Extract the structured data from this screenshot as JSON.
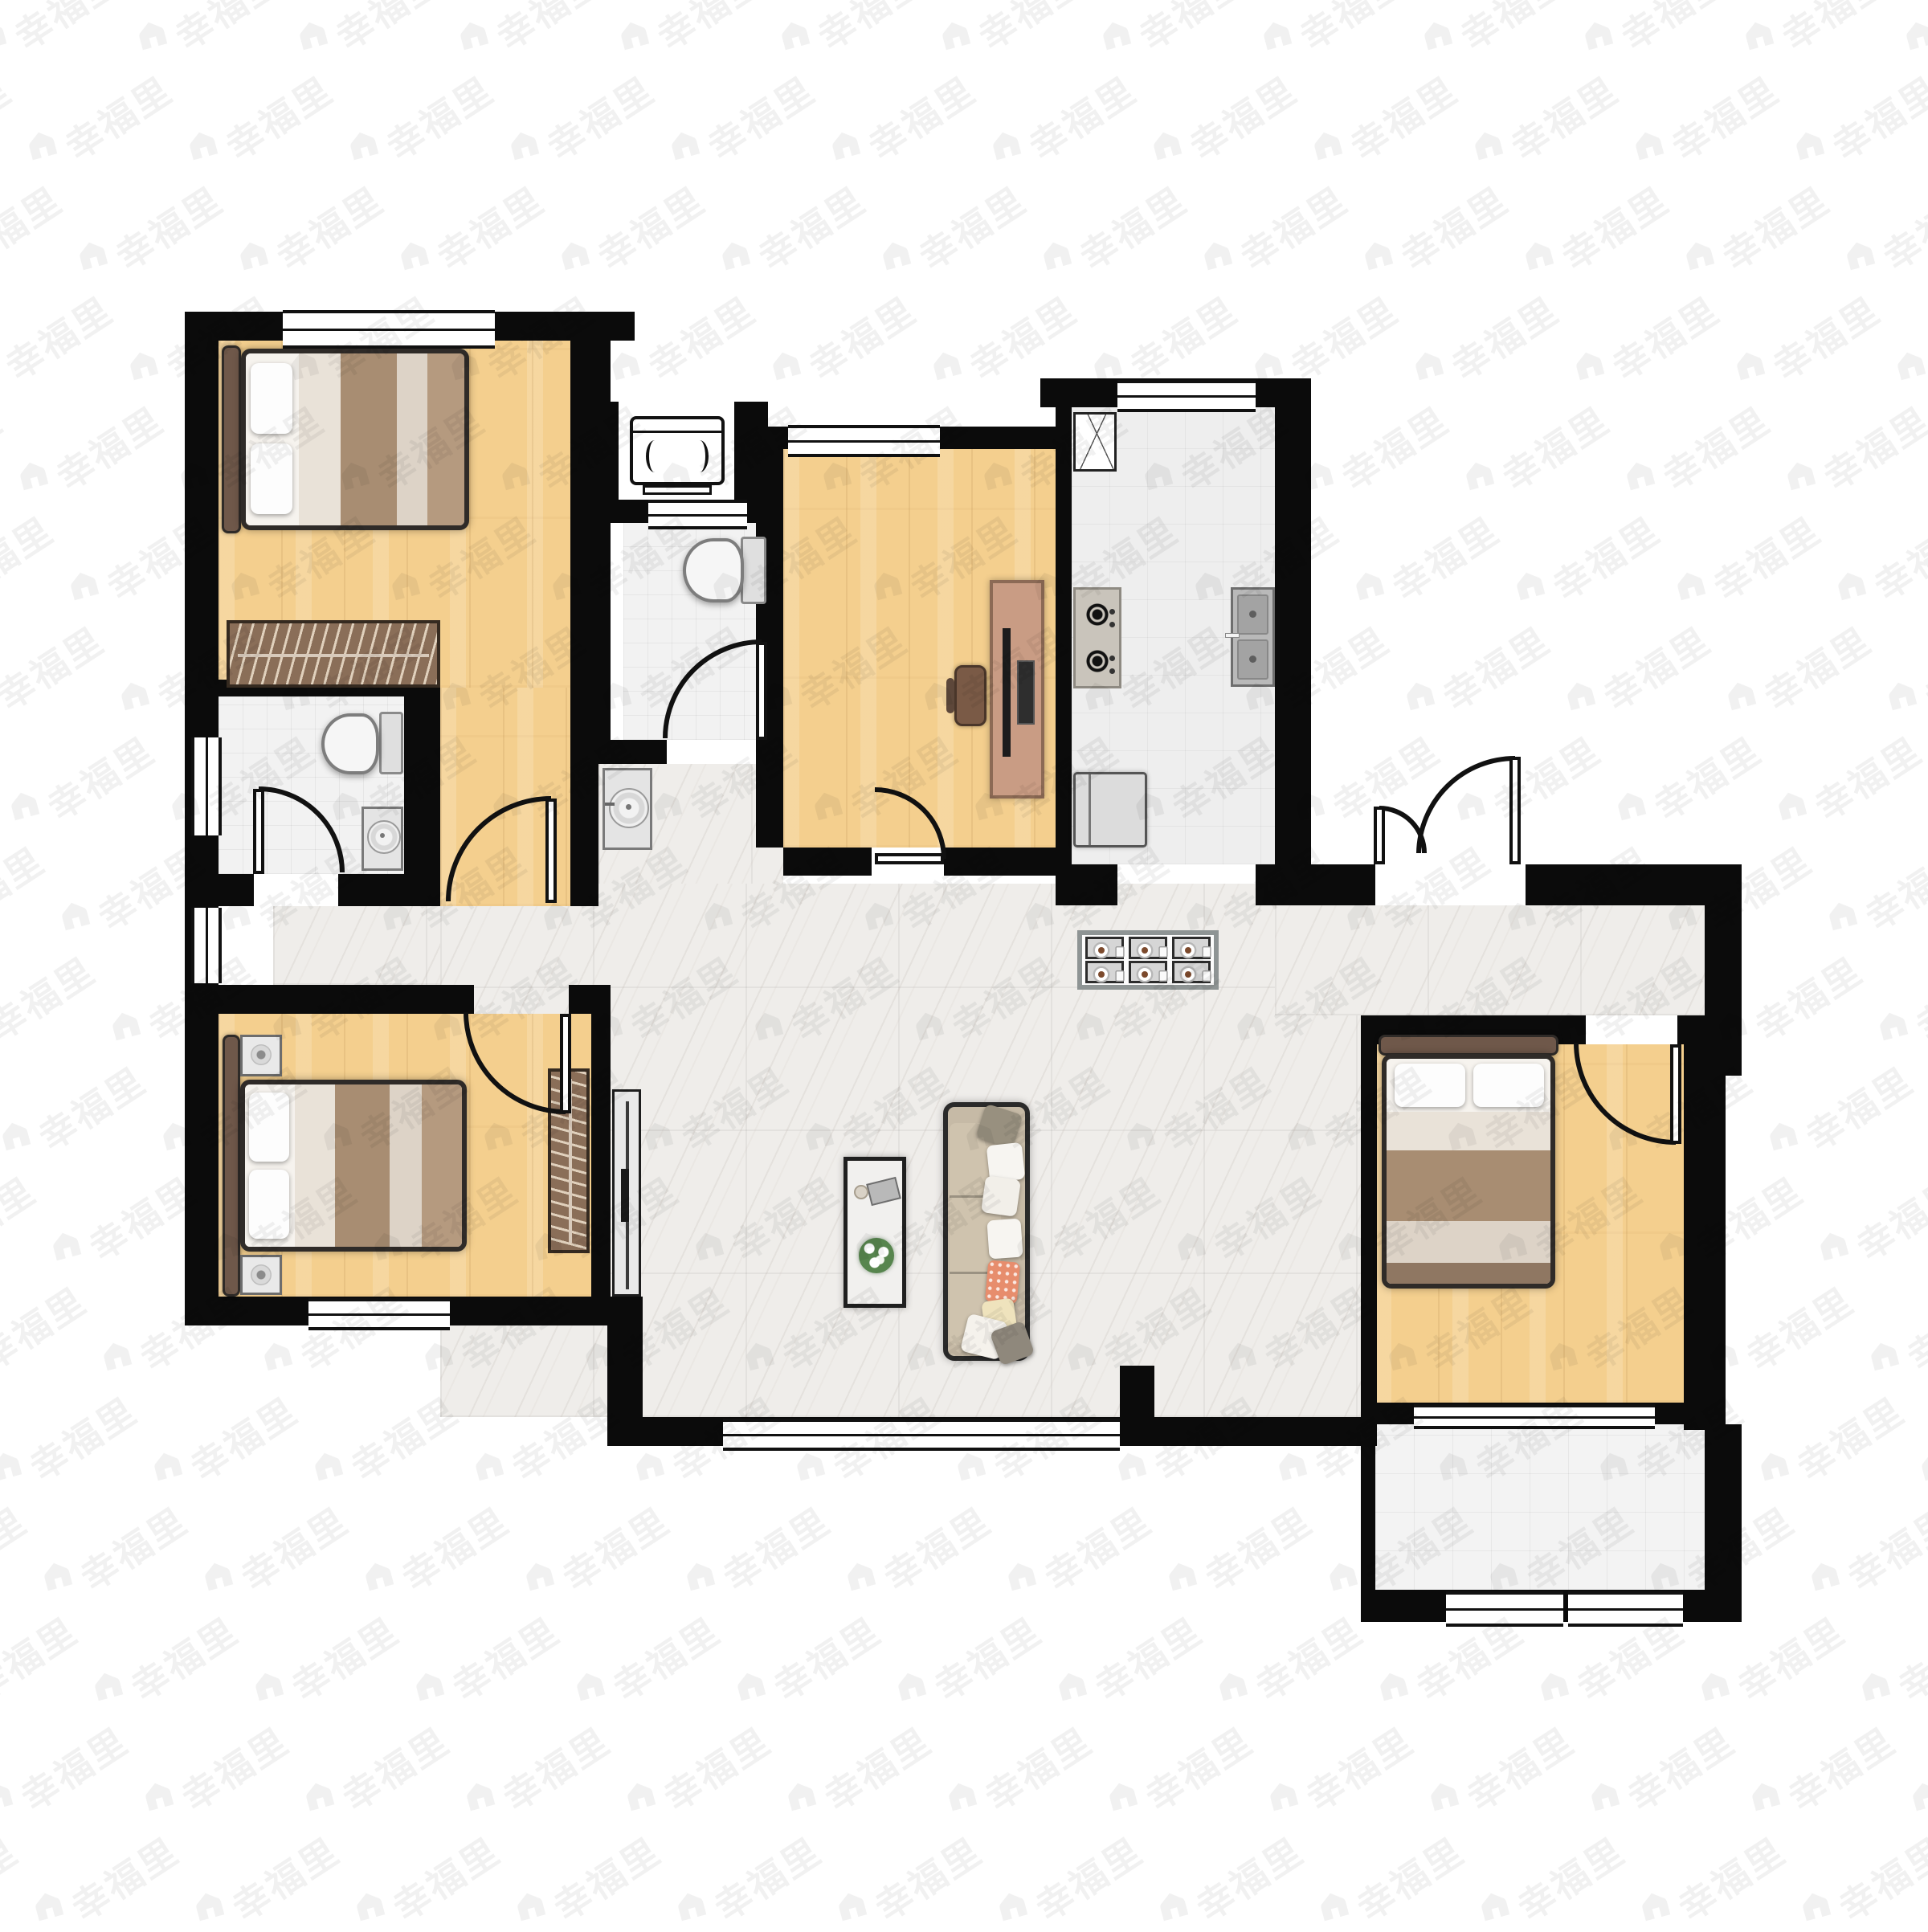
{
  "watermark": {
    "text": "幸福里",
    "icon": "house-icon",
    "color": "rgba(0,0,0,0.055)",
    "rows": 18,
    "cols": 14,
    "col_step": 200,
    "row_step": 137,
    "row_x_drift": 63,
    "text_size": 46,
    "icon_size": 42
  },
  "palette": {
    "wall": "#0b0b0b",
    "wood_floor": "#f4cf8e",
    "marble_floor": "#efedea",
    "bath_tile": "#f2f2f2",
    "kitchen_tile": "#eeeeee",
    "balcony_tile": "#f3f3f3",
    "wardrobe": "#8a6e58",
    "sofa": "#c6baa6",
    "accent_pillow": "#e78d6d",
    "chair": "#b5a485",
    "plant_green": "#3f7a3f"
  },
  "rooms": [
    {
      "name": "bedroom-top-left",
      "floor": "wood"
    },
    {
      "name": "bathroom-left",
      "floor": "tile"
    },
    {
      "name": "bedroom-bottom-left",
      "floor": "wood"
    },
    {
      "name": "bathroom-middle",
      "floor": "tile"
    },
    {
      "name": "study",
      "floor": "wood"
    },
    {
      "name": "kitchen",
      "floor": "tile"
    },
    {
      "name": "living-dining-hall",
      "floor": "marble"
    },
    {
      "name": "bedroom-right",
      "floor": "wood"
    },
    {
      "name": "balcony",
      "floor": "tile"
    }
  ],
  "furniture_icons": [
    "double-bed-icon",
    "wardrobe-icon",
    "nightstand-icon",
    "toilet-icon",
    "washbasin-icon",
    "washing-machine-icon",
    "desk-icon",
    "desk-chair-icon",
    "corner-cabinet-icon",
    "gas-stove-icon",
    "kitchen-sink-icon",
    "fridge-icon",
    "dining-table-icon",
    "dining-chair-icon",
    "sofa-icon",
    "coffee-table-icon",
    "tv-stand-icon",
    "plant-icon"
  ]
}
